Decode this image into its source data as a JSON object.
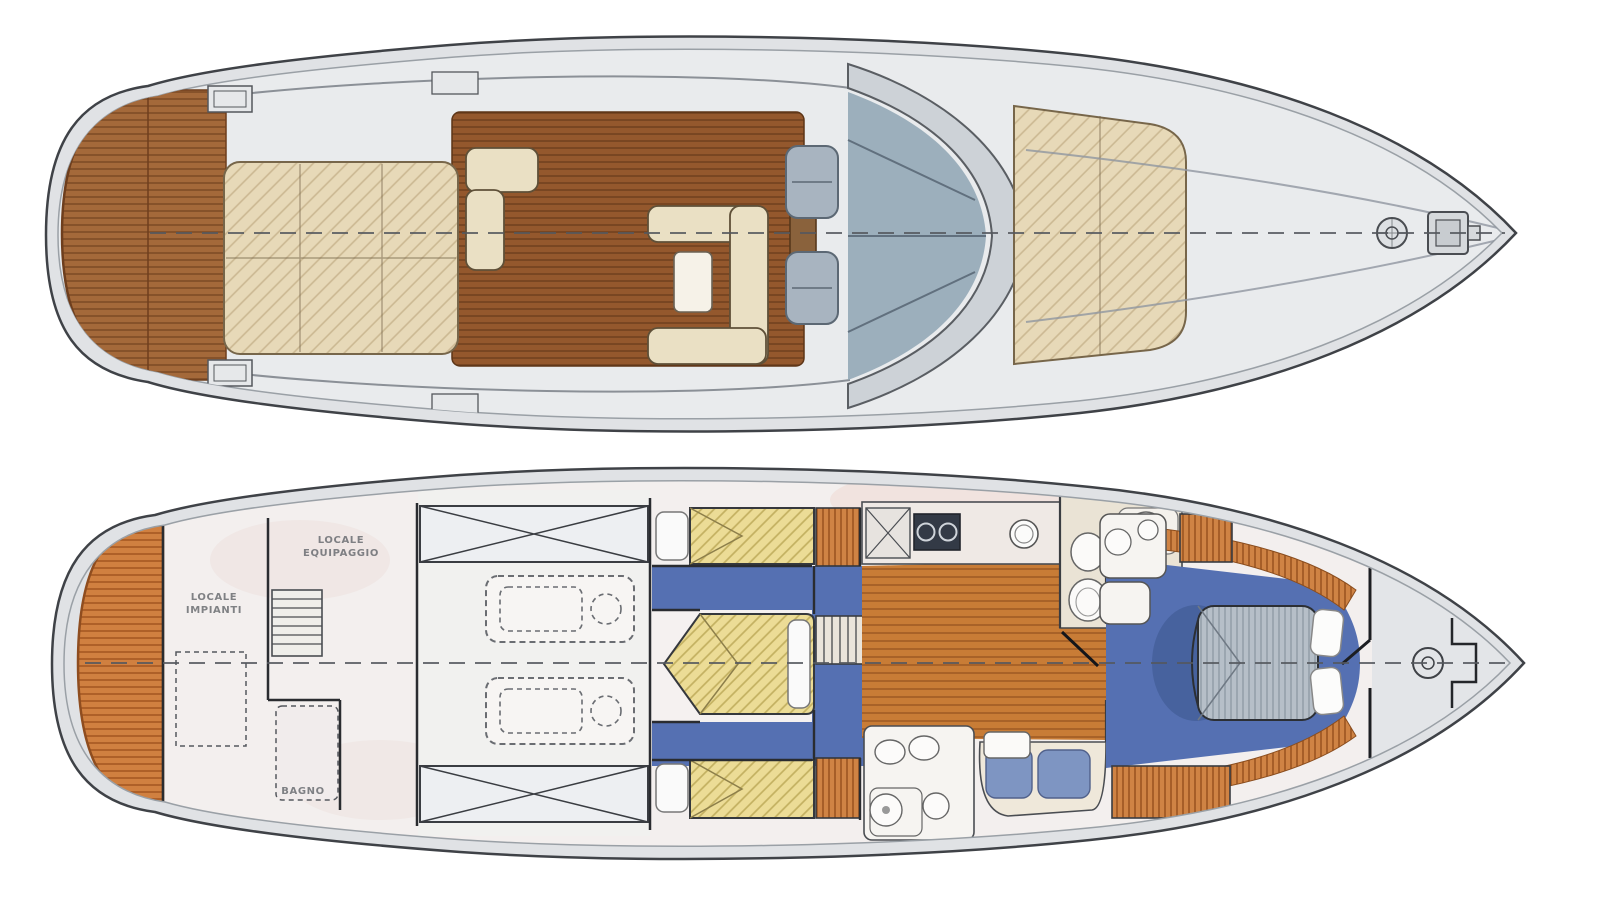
{
  "page": {
    "background": "#ffffff",
    "description": "Watercolor-style two-deck floor plan drawing of a motor yacht: main deck plan above, lower deck accommodation plan below"
  },
  "labels": {
    "equipment_room": {
      "line1": "LOCALE",
      "line2": "IMPIANTI"
    },
    "crew_quarters": {
      "line1": "LOCALE",
      "line2": "EQUIPAGGIO"
    },
    "bathroom": "BAGNO"
  },
  "palette": {
    "deck_gray": "#e0e2e5",
    "hull_line": "#3f4247",
    "teak_platform_top": "#a4693a",
    "teak_cockpit": "#94582d",
    "teak_orange_platform": "#d08040",
    "salon_wood": "#c87c36",
    "seat_cream": "#eae0c4",
    "sunpad_beige": "#e7d9b8",
    "mattress_yellow": "#ecdc96",
    "carpet_blue": "#5570b2",
    "windshield_glass": "#94a8b6",
    "master_bed_gray": "#b6bfc8",
    "wood_louver": "#cf8344",
    "interior_floor": "#f3efee",
    "fixture_white": "#f9f8f6"
  }
}
